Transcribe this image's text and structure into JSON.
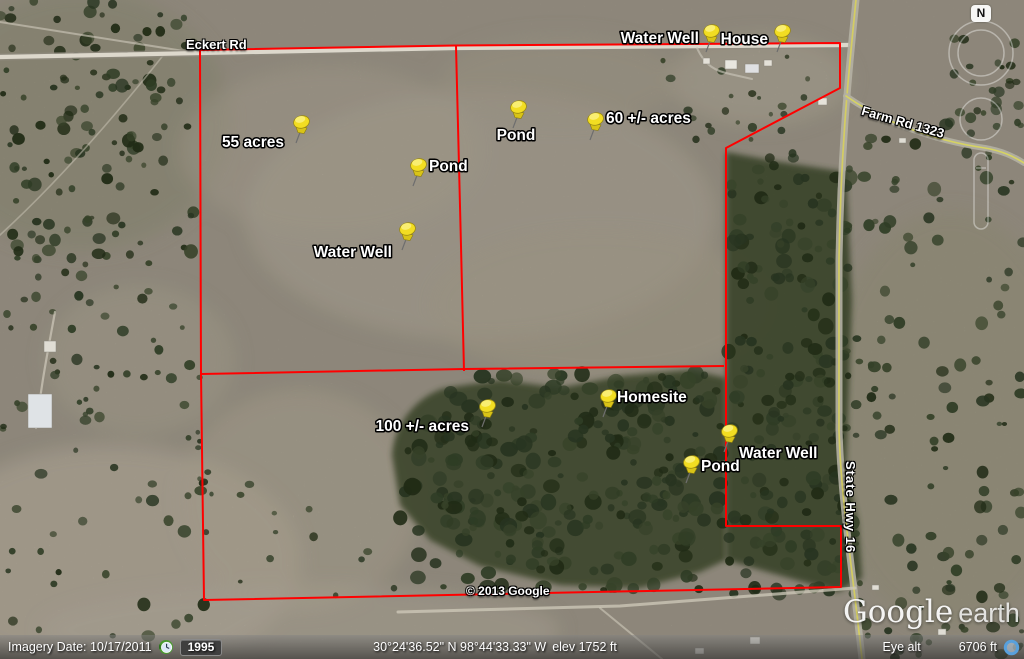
{
  "map": {
    "markers": [
      {
        "name": "water-well-north",
        "label": "Water Well",
        "pin": [
          706,
          52
        ],
        "label_pos": [
          699,
          43
        ],
        "anchor": "end"
      },
      {
        "name": "house",
        "label": "House",
        "pin": [
          777,
          52
        ],
        "label_pos": [
          768,
          44
        ],
        "anchor": "end"
      },
      {
        "name": "acreage-55",
        "label": "55 acres",
        "pin": [
          296,
          143
        ],
        "label_pos": [
          284,
          147
        ],
        "anchor": "end"
      },
      {
        "name": "pond-north",
        "label": "Pond",
        "pin": [
          513,
          128
        ],
        "label_pos": [
          516,
          140
        ],
        "anchor": "middle"
      },
      {
        "name": "acreage-60",
        "label": "60 +/- acres",
        "pin": [
          590,
          140
        ],
        "label_pos": [
          606,
          123
        ],
        "anchor": "start"
      },
      {
        "name": "pond-center",
        "label": "Pond",
        "pin": [
          413,
          186
        ],
        "label_pos": [
          429,
          171
        ],
        "anchor": "start"
      },
      {
        "name": "water-well-center",
        "label": "Water Well",
        "pin": [
          402,
          250
        ],
        "label_pos": [
          392,
          257
        ],
        "anchor": "end"
      },
      {
        "name": "acreage-100",
        "label": "100 +/- acres",
        "pin": [
          482,
          427
        ],
        "label_pos": [
          469,
          431
        ],
        "anchor": "end"
      },
      {
        "name": "homesite",
        "label": "Homesite",
        "pin": [
          603,
          417
        ],
        "label_pos": [
          617,
          402
        ],
        "anchor": "start"
      },
      {
        "name": "water-well-south",
        "label": "Water Well",
        "pin": [
          724,
          452
        ],
        "label_pos": [
          739,
          458
        ],
        "anchor": "start"
      },
      {
        "name": "pond-south",
        "label": "Pond",
        "pin": [
          686,
          483
        ],
        "label_pos": [
          701,
          471
        ],
        "anchor": "start"
      }
    ],
    "roads": {
      "eckert": "Eckert Rd",
      "farm": "Farm Rd 1323",
      "hwy": "State Hwy 16"
    },
    "copyright": "© 2013 Google",
    "logo_google": "Google",
    "logo_earth": "earth",
    "compass_n": "N",
    "colors": {
      "boundary": "#ff0000",
      "pin_head": "#f2dd22",
      "label_text": "#ffffff"
    }
  },
  "status_bar": {
    "imagery_date": "Imagery Date: 10/17/2011",
    "year_badge": "1995",
    "coordinates": "30°24'36.52\" N   98°44'33.33\" W",
    "elevation": "elev   1752 ft",
    "eye_alt_label": "Eye alt",
    "eye_alt_value": "6706 ft"
  }
}
